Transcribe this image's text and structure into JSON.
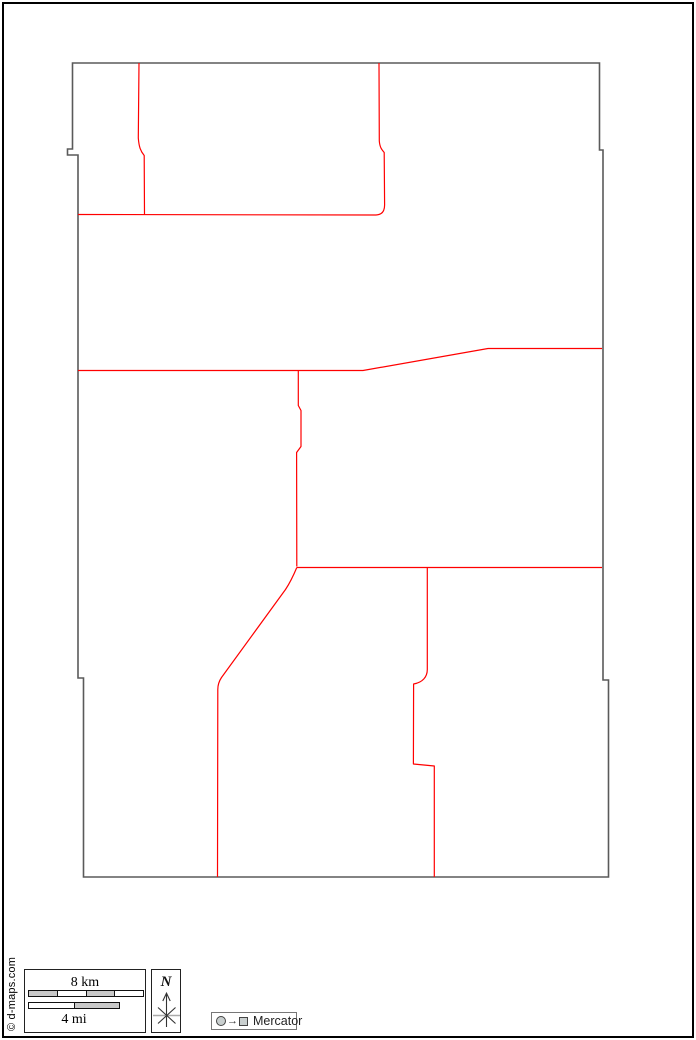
{
  "frame": {
    "border_color": "#000000"
  },
  "copyright": {
    "text": "© d-maps.com"
  },
  "map": {
    "outline_color": "#5a5a5a",
    "boundary_color": "#ff0000",
    "outline_path": "M72.5,63 L599.5,63 L599.5,150 L603,150 L603,680 L608.5,680 L608.5,877 L83.5,877 L83.5,678 L78,678 L78,155 L67.5,155 L67.5,149 L72.5,149 Z",
    "boundaries": [
      {
        "name": "northwest-vertical",
        "path": "M139,63 L138.3,138 C139,147 140.5,151 144.2,155.5 L144.5,214.5"
      },
      {
        "name": "north-horizontal",
        "path": "M78,214.5 L376,215"
      },
      {
        "name": "north-central-vertical",
        "path": "M379,63 L379.3,141 C379.8,147 381.5,149.5 384.2,152.5 L384.6,205 C384.6,211 382,214.8 376,215"
      },
      {
        "name": "central-horizontal",
        "path": "M78,370.5 L363,370.5 L488,348.5 L602,348.5"
      },
      {
        "name": "central-vertical",
        "path": "M298.3,370.5 L298.3,405.5 L301,410.5 L301,446.5 L296.6,452.5 L296.8,566.5"
      },
      {
        "name": "south-horizontal",
        "path": "M296.8,567.5 L602,567.5"
      },
      {
        "name": "southwest-diagonal",
        "path": "M296.8,567.5 C292,579 289.5,583.5 285.5,589.5 L221.5,677.5 C218.8,681.5 217.8,684.5 217.8,689.5 L217.5,877"
      },
      {
        "name": "southeast-vertical",
        "path": "M427.3,567.5 L427.3,669.5 C427.3,677 422.5,682.5 413.6,684 L413.4,764 L434.3,766 L434.3,877"
      }
    ]
  },
  "scale": {
    "km_label": "8 km",
    "mi_label": "4 mi",
    "km_segments": [
      "#c9c9c9",
      "#ffffff",
      "#c9c9c9",
      "#ffffff"
    ],
    "mi_segments": [
      "#ffffff",
      "#c9c9c9"
    ]
  },
  "compass": {
    "label": "N"
  },
  "projection": {
    "label": "Mercator",
    "arrow_glyph": "→"
  }
}
